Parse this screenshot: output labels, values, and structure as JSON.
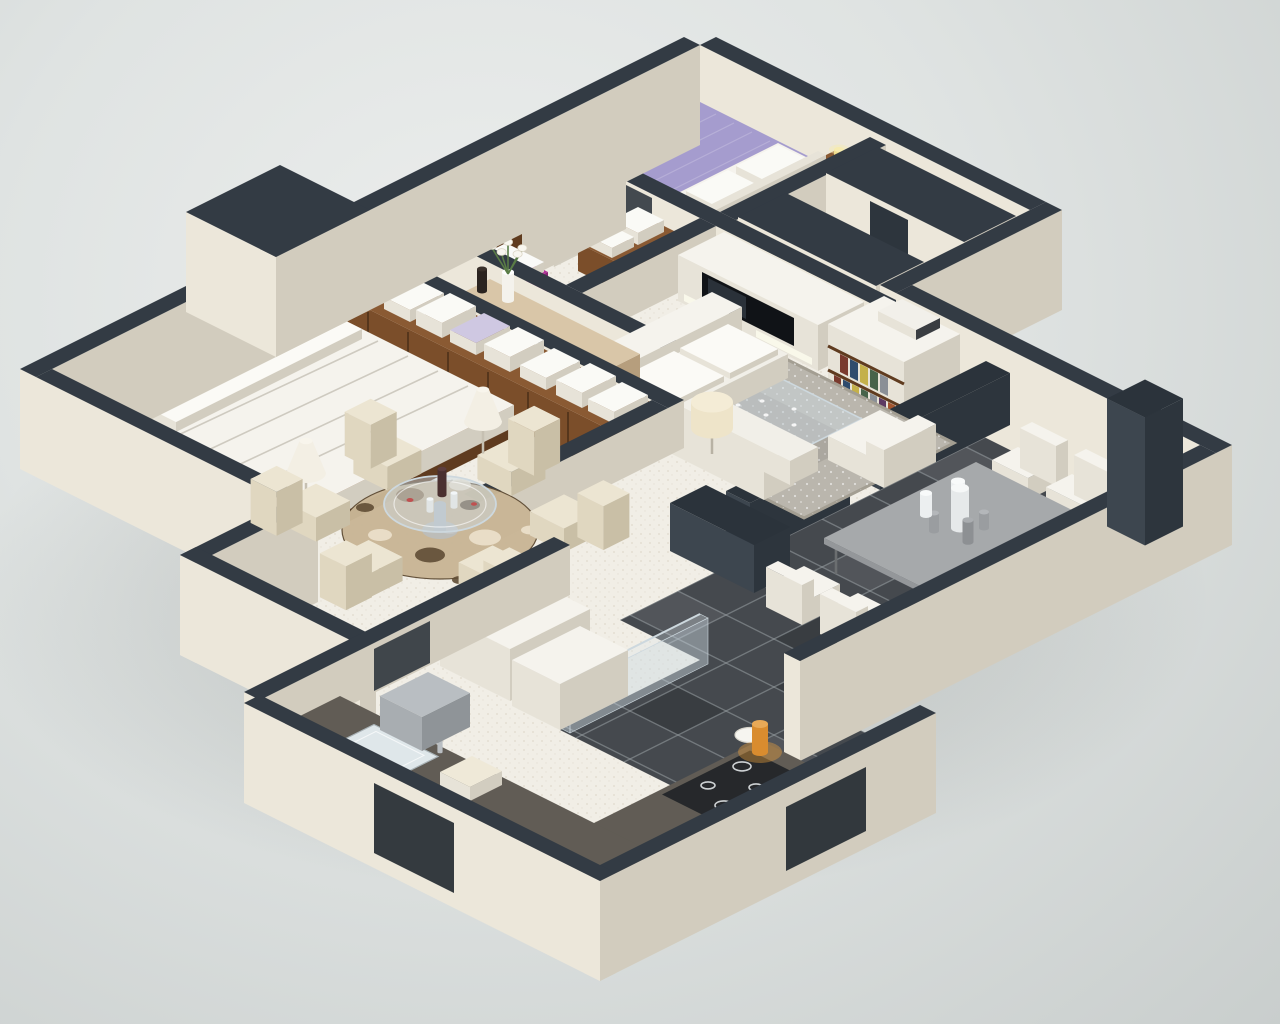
{
  "scene": {
    "title": "3D isometric apartment floor plan render",
    "description": "Cutaway axonometric render of a three-bedroom apartment with furnished rooms on a light grey backdrop"
  },
  "palette": {
    "bg_inner": "#eceeed",
    "bg_outer": "#c9cecd",
    "shadow": "rgba(70,76,72,0.28)",
    "wall_top": "#333b44",
    "wall_top_dark": "#2b333b",
    "wall_sw": "#ece7da",
    "wall_se": "#d2ccbe",
    "dark_sw": "#3d464f",
    "dark_se": "#2d353d",
    "floor": "#f1eee6",
    "speck": "#cbc2ae",
    "tile": "#45494e",
    "tile_dark": "rgba(0,0,0,0.16)",
    "tile_light": "rgba(255,255,255,0.07)",
    "grout": "#9aa0a4",
    "wood_top": "#8a5a33",
    "wood_sw": "#7b4e2a",
    "wood_se": "#5f3b1f",
    "wood_line": "#4e3118",
    "lightwood_top": "#d9c6a8",
    "lightwood_sw": "#cdb894",
    "lightwood_se": "#b69e7d",
    "white_top": "#f5f3ed",
    "white_sw": "#e7e3d8",
    "white_se": "#d2cdc0",
    "purple_top": "#a59cce",
    "purple_sw": "#968cc0",
    "purple_se": "#7f76ab",
    "magenta_top": "#b23399",
    "magenta_sw": "#a12c8a",
    "magenta_se": "#8b2376",
    "graytable_top": "#a6a9ab",
    "graytable_sw": "#94979a",
    "graytable_se": "#7f8285",
    "chair_top": "#ece5d2",
    "chair_sw": "#e0d7c0",
    "chair_se": "#c9bfa6",
    "rug": "#bab6ad",
    "rug_border": "#a39e92",
    "rug_dot": "rgba(255,255,255,0.55)",
    "roundrug": "#c9b696",
    "circle_a": "#8a6f4e",
    "circle_b": "#ece1cc",
    "circle_c": "#5f4c35",
    "glass": "rgba(205,218,226,0.45)",
    "glass_edge": "#cdd8de",
    "black": "#17191c",
    "tv": "#101317",
    "counter_top": "#615c55",
    "counter_sw": "#6b665f",
    "counter_se": "#4e4a44",
    "counter_face": "#eceae2",
    "stove": "#26282b",
    "ring": "#cdd1d3",
    "steel": "#b9bec2",
    "orange": "#d98c2f",
    "orange_glow": "rgba(235,160,60,0.40)",
    "green": "#5a7c46",
    "lamp": "#eee4c9",
    "lamp_se": "#ddd0ae",
    "yellow": "#ecd677",
    "bottle": "#4a3030",
    "statue": "#2b2420",
    "sinkwell": "#dfe7ea",
    "book_colors": [
      "#7a3b2e",
      "#2f4b6d",
      "#c4b04a",
      "#47634a",
      "#8a8f96",
      "#5d3a63",
      "#a3552f"
    ]
  },
  "elements": [
    {
      "id": "building-shadow",
      "label": "soft drop shadow under model"
    },
    {
      "id": "floor-main",
      "label": "cream speckled floor slab"
    },
    {
      "id": "floor-tiles",
      "label": "dark grey tiled dining and kitchen floor"
    },
    {
      "id": "exterior-wall",
      "label": "cutaway exterior wall, cream with dark top"
    },
    {
      "id": "interior-wall",
      "label": "cutaway interior partition wall"
    },
    {
      "id": "partition-dark",
      "label": "dark charcoal partition slab"
    },
    {
      "id": "bedroom2-bed",
      "label": "double bed with purple bedspread"
    },
    {
      "id": "bedroom2-pillows",
      "label": "white pillows"
    },
    {
      "id": "bedroom2-nightstand",
      "label": "wooden nightstand with yellow lamp"
    },
    {
      "id": "closet-panels",
      "label": "built-in wardrobe panels"
    },
    {
      "id": "bath-shower",
      "label": "glass shower enclosure"
    },
    {
      "id": "bath-vanity-magenta",
      "label": "magenta vanity with washbasin"
    },
    {
      "id": "bath-sink",
      "label": "washbasin on wooden cabinet"
    },
    {
      "id": "bath-toilet",
      "label": "toilet"
    },
    {
      "id": "bath-towel-shelf",
      "label": "wooden shelf with folded towels"
    },
    {
      "id": "tv-unit",
      "label": "white media wall with flat-screen TV"
    },
    {
      "id": "bookshelf",
      "label": "white bookshelf with books"
    },
    {
      "id": "living-rug",
      "label": "grey patterned area rug"
    },
    {
      "id": "coffee-table",
      "label": "glass coffee table"
    },
    {
      "id": "sofa",
      "label": "white L-shaped sectional sofa"
    },
    {
      "id": "armchair",
      "label": "white armchair"
    },
    {
      "id": "drum-lamp",
      "label": "cream drum table lamp"
    },
    {
      "id": "sideboard",
      "label": "light wood sideboard"
    },
    {
      "id": "flower-vase",
      "label": "white vase with calla lilies"
    },
    {
      "id": "statue",
      "label": "dark decorative statue"
    },
    {
      "id": "master-wardrobe",
      "label": "walnut wardrobe with linen boxes on top"
    },
    {
      "id": "master-bed",
      "label": "double bed with white draped duvet"
    },
    {
      "id": "floor-lamp",
      "label": "white cone floor lamp"
    },
    {
      "id": "nook-rug",
      "label": "round rug with circle pattern"
    },
    {
      "id": "nook-table",
      "label": "round glass dining table with wine bottle"
    },
    {
      "id": "nook-chair",
      "label": "cream upholstered dining chair"
    },
    {
      "id": "dining-table",
      "label": "grey rectangular dining table"
    },
    {
      "id": "dining-chair",
      "label": "white dining chair"
    },
    {
      "id": "dining-vases",
      "label": "white and grey bottle vases centerpiece"
    },
    {
      "id": "pillar",
      "label": "dark chimney pillar"
    },
    {
      "id": "glass-partition",
      "label": "glass partition panel"
    },
    {
      "id": "fridge",
      "label": "white refrigerator and cabinet volumes"
    },
    {
      "id": "kitchen-counter",
      "label": "L-shaped dark kitchen counter"
    },
    {
      "id": "kitchen-sink",
      "label": "inset kitchen sink with faucet"
    },
    {
      "id": "stove",
      "label": "black cooktop with four burners"
    },
    {
      "id": "plate",
      "label": "white plate"
    },
    {
      "id": "orange-lamp",
      "label": "small orange counter lamp"
    }
  ]
}
